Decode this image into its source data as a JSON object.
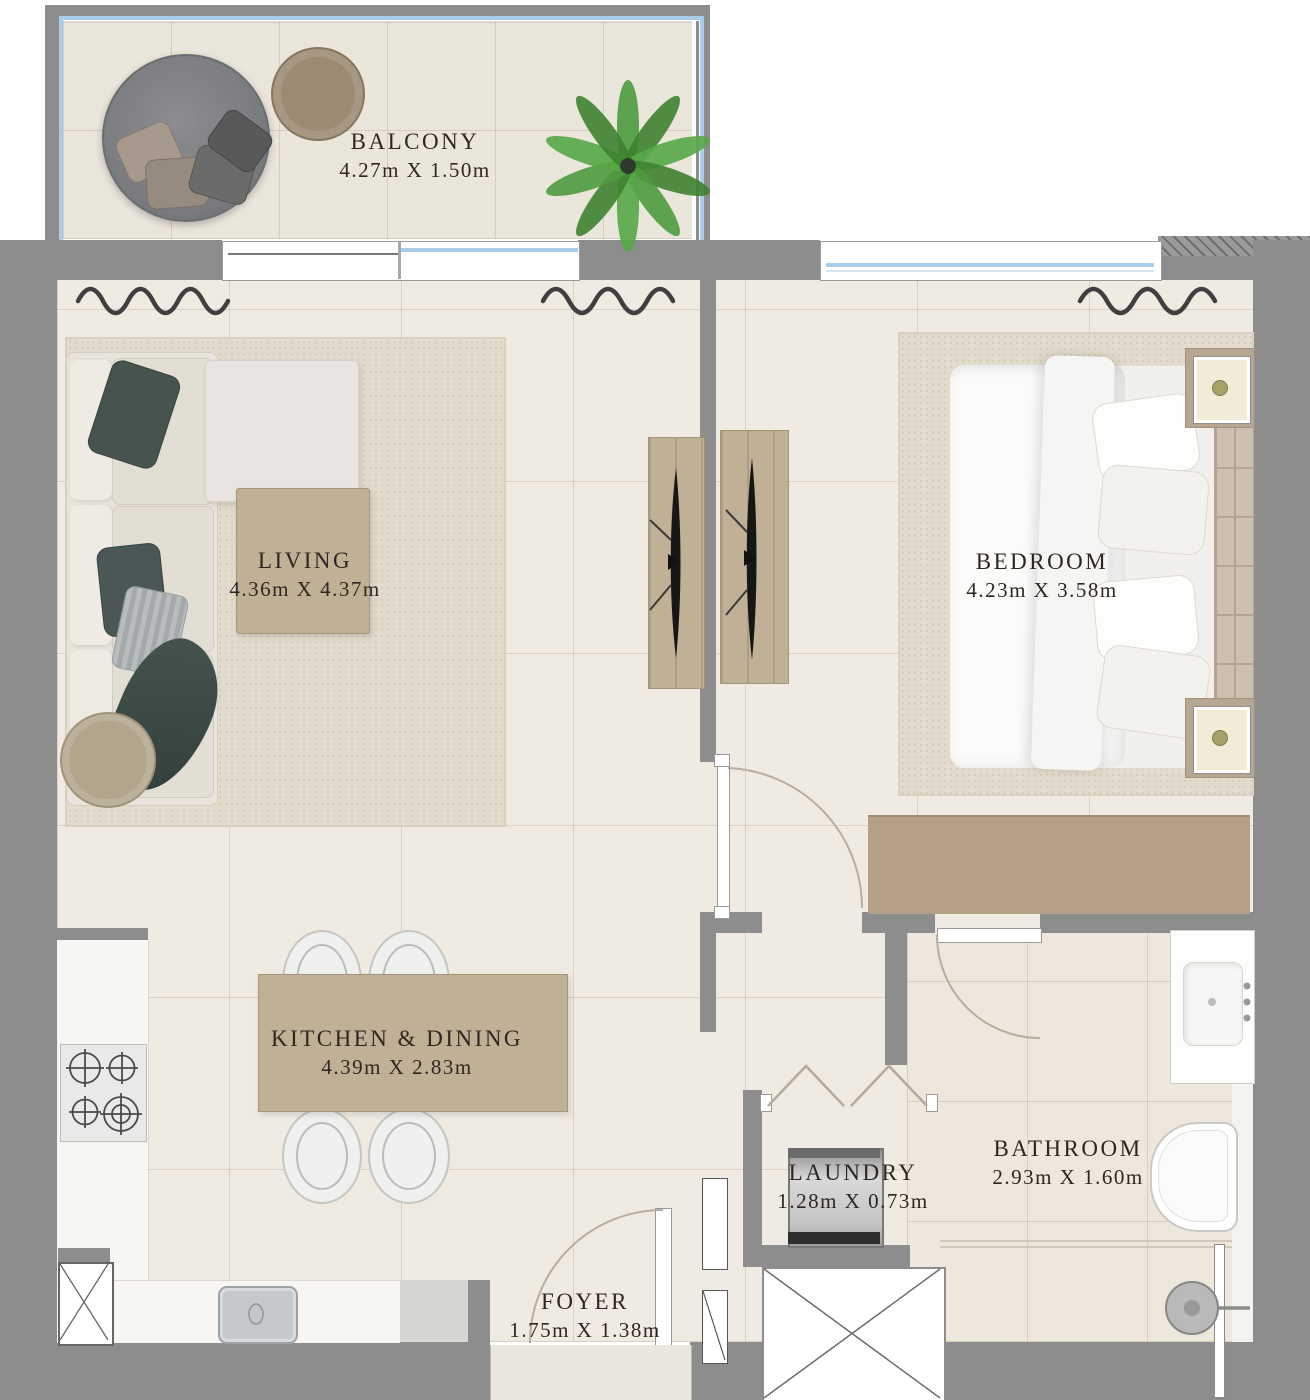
{
  "rooms": [
    {
      "id": "balcony",
      "name": "BALCONY",
      "dims": "4.27m X 1.50m"
    },
    {
      "id": "living",
      "name": "LIVING",
      "dims": "4.36m X 4.37m"
    },
    {
      "id": "bedroom",
      "name": "BEDROOM",
      "dims": "4.23m X 3.58m"
    },
    {
      "id": "kitchen_dining",
      "name": "KITCHEN & DINING",
      "dims": "4.39m X 2.83m"
    },
    {
      "id": "laundry",
      "name": "LAUNDRY",
      "dims": "1.28m X 0.73m"
    },
    {
      "id": "bathroom",
      "name": "BATHROOM",
      "dims": "2.93m X 1.60m"
    },
    {
      "id": "foyer",
      "name": "FOYER",
      "dims": "1.75m X 1.38m"
    }
  ],
  "colors": {
    "wall": "#8d8d8d",
    "floor": "#f0ebe2",
    "balcony_floor": "#ebe6dc",
    "rug": "#e2dbcb",
    "wood": "#c0b095",
    "wood_dark": "#a6957a",
    "wardrobe": "#b3a086",
    "sofa": "#e8e4db",
    "cushion_dark": "#47534f",
    "glass": "#a9cde9",
    "plant": "#4e9a3e",
    "counter": "#f7f6f2",
    "steel": "#c6c9cc",
    "machine": "#bfbfbf",
    "arc": "#b6ae9f",
    "curtain": "#3f3f3f",
    "text": "#2e2721"
  }
}
